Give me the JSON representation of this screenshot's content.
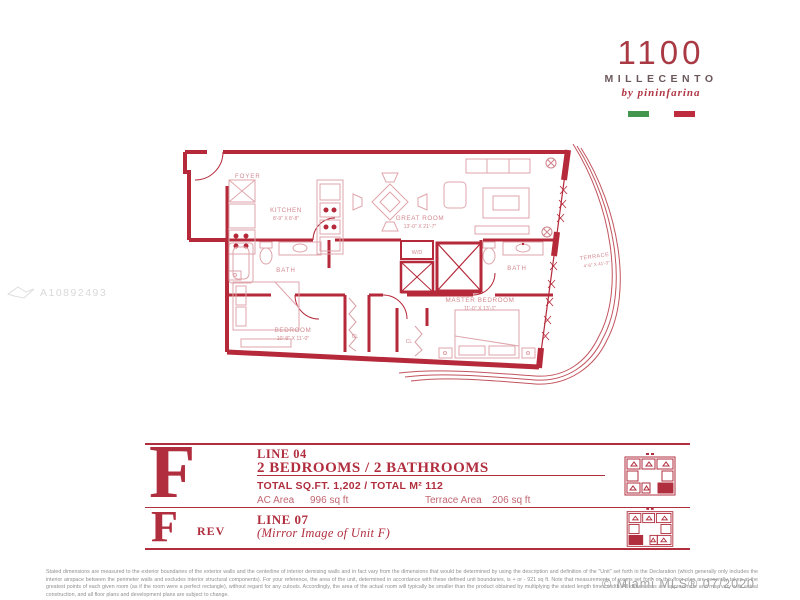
{
  "logo": {
    "number": "1100",
    "name": "MILLECENTO",
    "byline": "by pininfarina"
  },
  "watermark": {
    "id": "A10892493"
  },
  "floorplan": {
    "wall_color": "#b5293a",
    "rooms": {
      "foyer": {
        "label": "FOYER"
      },
      "kitchen": {
        "label": "KITCHEN",
        "dim": "8'-9\" X 8'-8\""
      },
      "great_room": {
        "label": "GREAT ROOM",
        "dim": "13'-0\" X 21'-7\""
      },
      "bath_1": {
        "label": "BATH"
      },
      "bath_2": {
        "label": "BATH"
      },
      "laundry": {
        "label": "W/D"
      },
      "terrace": {
        "label": "TERRACE",
        "dim": "4'-6\" X 41'-3\""
      },
      "bedroom": {
        "label": "BEDROOM",
        "dim": "10'-8\" X 11'-0\""
      },
      "master_bedroom": {
        "label": "MASTER BEDROOM",
        "dim": "11'-0\" X 13'-1\""
      },
      "closet_1": {
        "label": "CL"
      },
      "closet_2": {
        "label": "CL"
      }
    }
  },
  "unit_f": {
    "letter": "F",
    "line": "LINE 04",
    "configuration": "2 BEDROOMS / 2 BATHROOMS",
    "total": "TOTAL SQ.FT. 1,202 / TOTAL M²  112",
    "ac_area_label": "AC Area",
    "ac_area_value": "996 sq ft",
    "terrace_area_label": "Terrace Area",
    "terrace_area_value": "206 sq ft"
  },
  "unit_f_rev": {
    "letter": "F",
    "suffix": "REV",
    "line": "LINE 07",
    "subtitle": "(Mirror Image of Unit F)"
  },
  "footer": {
    "disclaimer": "Stated dimensions are measured to the exterior boundaries of the exterior walls and the centerline of interior demising walls and in fact vary from the dimensions that would be determined by using the description and definition of the \"Unit\" set forth in the Declaration (which generally only includes the interior airspace between the perimeter walls and excludes interior structural components). For your reference, the area of the unit, determined in accordance with these defined unit boundaries, is + or - 921 sq ft. Note that measurements of rooms set forth on this floor plan are generally taken at the greatest points of each given room (as if the room were a perfect rectangle), without regard for any cutouts. Accordingly, the area of the actual room will typically be smaller than the product obtained by multiplying the stated length times width. All dimensions are approximate and may vary with actual construction, and all floor plans and development plans are subject to change.",
    "credit": "© Miami MLS® 07/2020"
  }
}
